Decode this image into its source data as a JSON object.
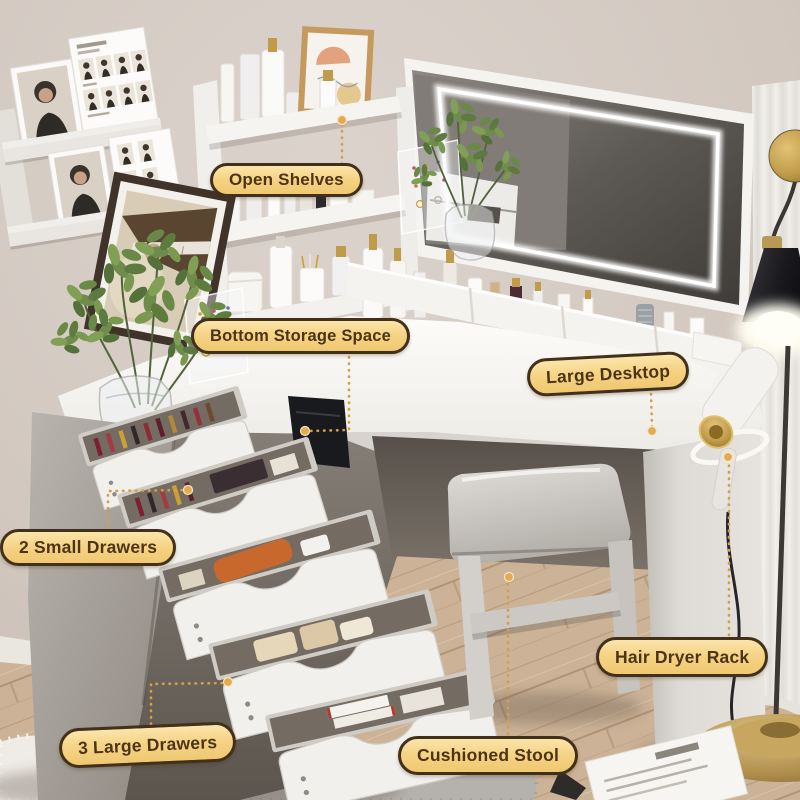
{
  "callouts": {
    "open_shelves": {
      "label": "Open Shelves"
    },
    "bottom_storage": {
      "label": "Bottom Storage Space"
    },
    "large_desktop": {
      "label": "Large Desktop"
    },
    "small_drawers": {
      "label": "2 Small Drawers"
    },
    "large_drawers": {
      "label": "3 Large Drawers"
    },
    "cushioned_stool": {
      "label": "Cushioned Stool"
    },
    "hair_dryer_rack": {
      "label": "Hair Dryer Rack"
    }
  },
  "colors": {
    "callout_background": "#f6d486",
    "callout_background_top": "#fbe5ab",
    "callout_border": "#42301a",
    "callout_text": "#4b3418",
    "connector_gold": "#d1a049",
    "wall_beige": "#d3c9c1",
    "floor_wood": "#c7ac8e",
    "furniture_white": "#f4f2ee",
    "furniture_grey": "#a8a29c",
    "mirror_glass": "#5d5954",
    "led_glow": "#ffffff",
    "lamp_shade_black": "#1a1a1e",
    "brass_gold": "#c09c4a",
    "plant_green": "#6f8d4a",
    "stool_grey": "#c6c2bd"
  }
}
